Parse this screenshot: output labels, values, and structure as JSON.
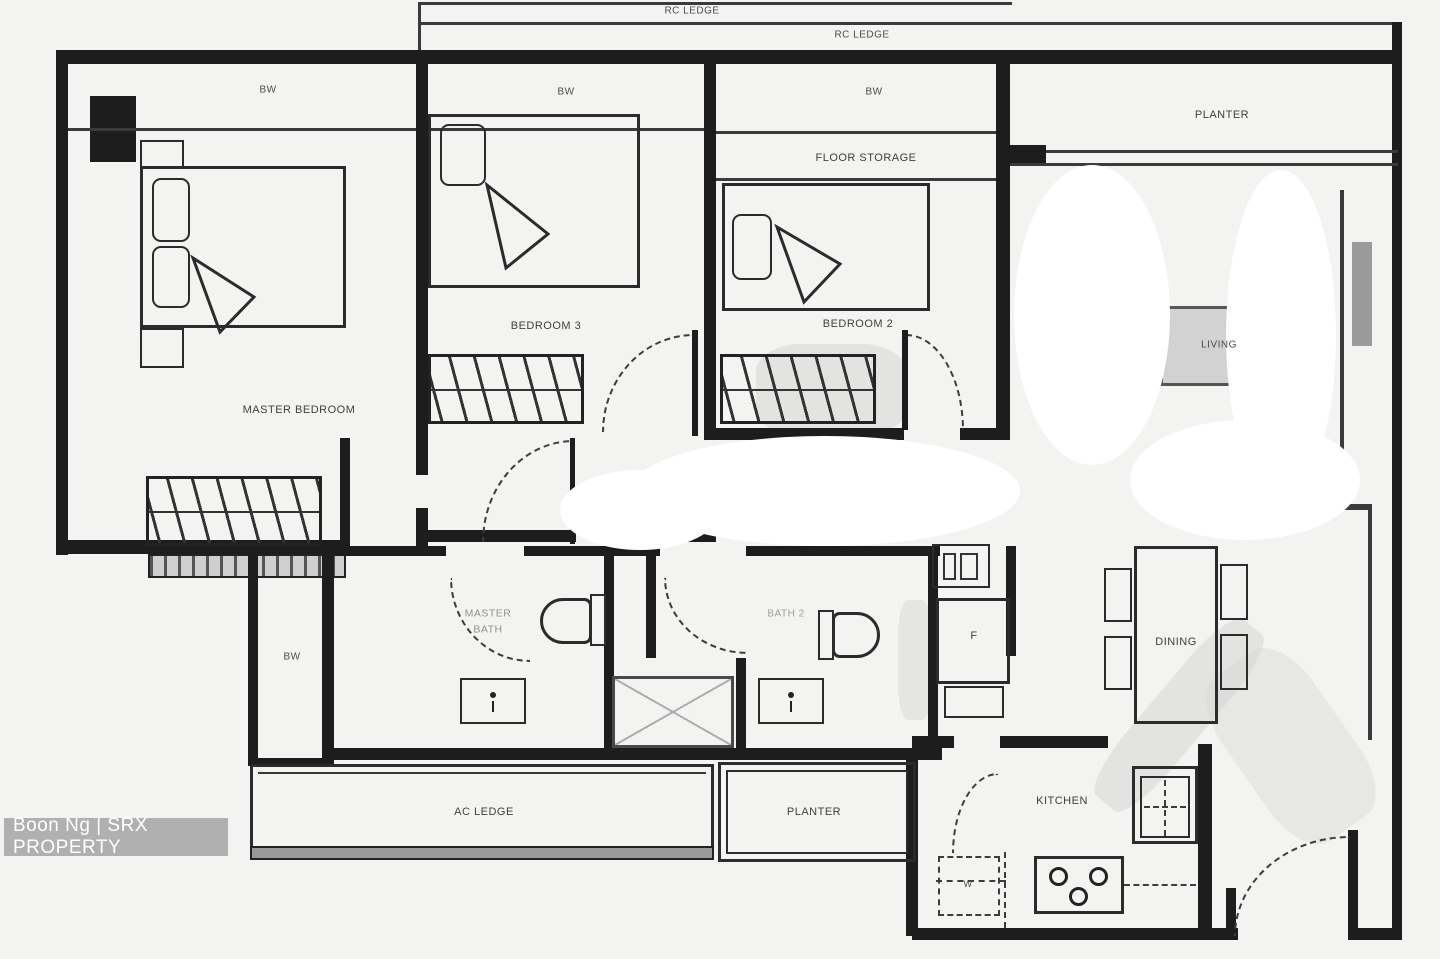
{
  "labels": {
    "rc_ledge_outer": "RC LEDGE",
    "rc_ledge_inner": "RC LEDGE",
    "bw_master": "BW",
    "bw_bedroom3": "BW",
    "bw_bedroom2": "BW",
    "bw_side": "BW",
    "planter_top": "PLANTER",
    "floor_storage": "FLOOR STORAGE",
    "master_bedroom": "MASTER BEDROOM",
    "bedroom3": "BEDROOM 3",
    "bedroom2": "BEDROOM 2",
    "living": "LIVING",
    "master_bath": "MASTER BATH",
    "bath2": "BATH 2",
    "fridge": "F",
    "washer": "W",
    "dining": "DINING",
    "ac_ledge": "AC LEDGE",
    "planter_bottom": "PLANTER",
    "kitchen": "KITCHEN"
  },
  "watermark": {
    "credit": "Boon Ng | SRX PROPERTY"
  },
  "colors": {
    "wall": "#1d1d1d",
    "background": "#f3f3f1",
    "watermark_bar": "#b0b0b0",
    "accent_gray": "#d2d2d2"
  }
}
